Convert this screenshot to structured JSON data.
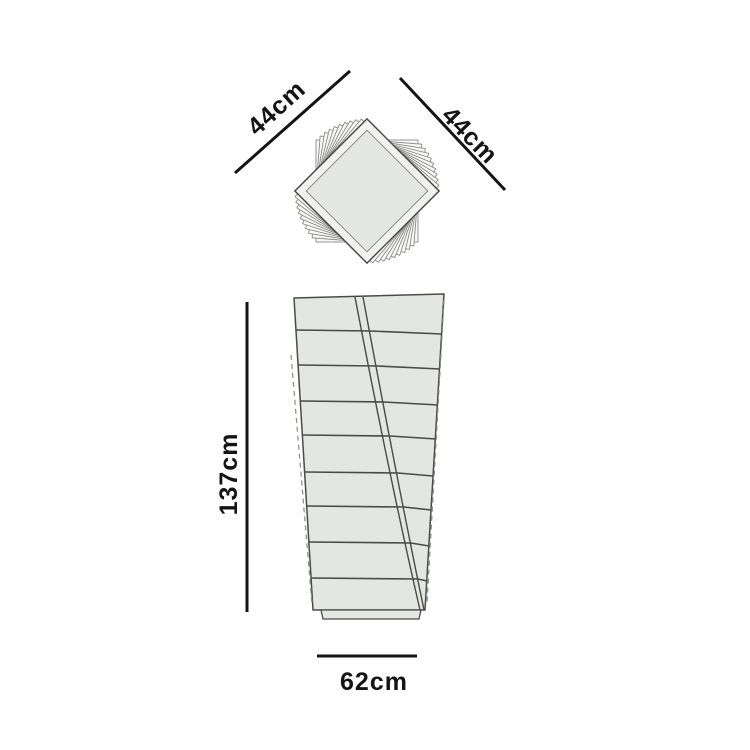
{
  "diagram": {
    "type": "furniture-dimension-drawing",
    "views": {
      "top": {
        "label_left": "44cm",
        "label_right": "44cm"
      },
      "front": {
        "label_height": "137cm",
        "label_width": "62cm",
        "drawer_rows": 9
      }
    },
    "colors": {
      "background": "#ffffff",
      "panel_fill": "#e4e6e1",
      "lid_fill": "#f2f3ef",
      "under_fill": "#f8f8f6",
      "outline": "#4a4a48",
      "thin_line": "#8a8a88",
      "dimension": "#141414"
    }
  }
}
